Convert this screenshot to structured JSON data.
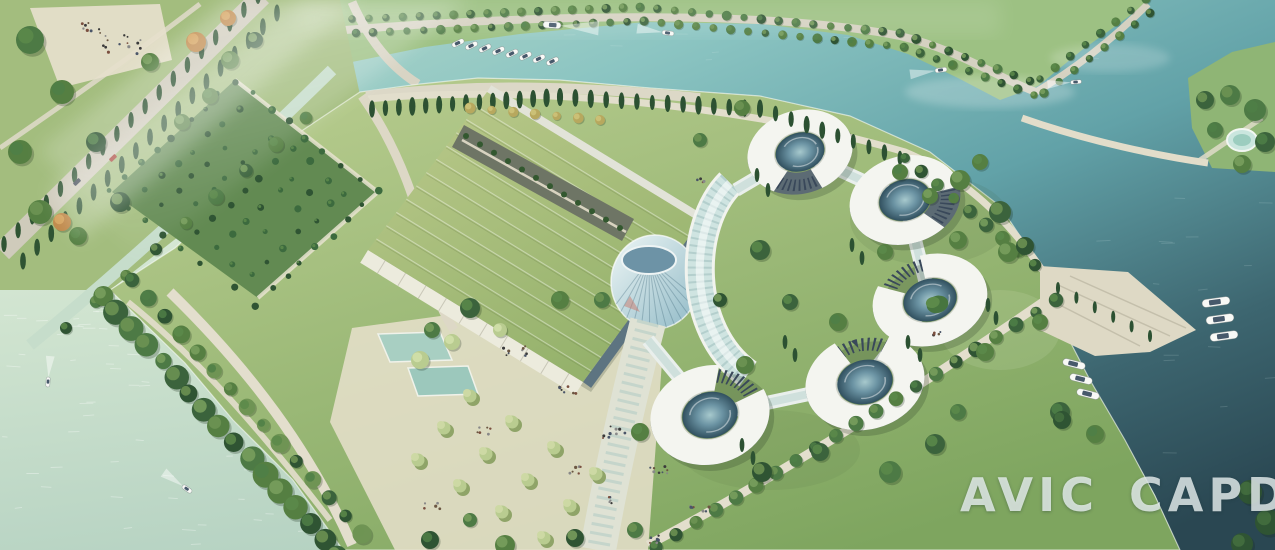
{
  "watermark": {
    "brand": "AVIC",
    "suffix": "CAPDI"
  },
  "palette": {
    "water_pale_light": "#e9f3e2",
    "water_pale": "#c4dbc8",
    "water_teal": "#7fbec0",
    "water_deep": "#2a4752",
    "bank_grass": "#9dc183",
    "island_grass_light": "#bccf92",
    "island_grass": "#7ea55f",
    "forest_green": "#628a52",
    "tree_dark": "#2f5433",
    "tree_mid": "#4d7a45",
    "tree_light": "#b9cc90",
    "tree_autumn": "#c08a4c",
    "roof_green_light": "#bcca8c",
    "roof_green": "#95b26c",
    "building_white": "#f4f5f0",
    "facade_grey": "#5c6b74",
    "glass_teal": "#cfe4e1",
    "glass_dark": "#31505f",
    "path_light": "#e7e1cd",
    "road_grey": "#d5d1c1",
    "boat_white": "#f8f9f6",
    "watermark": "rgba(234,241,241,0.8)"
  }
}
